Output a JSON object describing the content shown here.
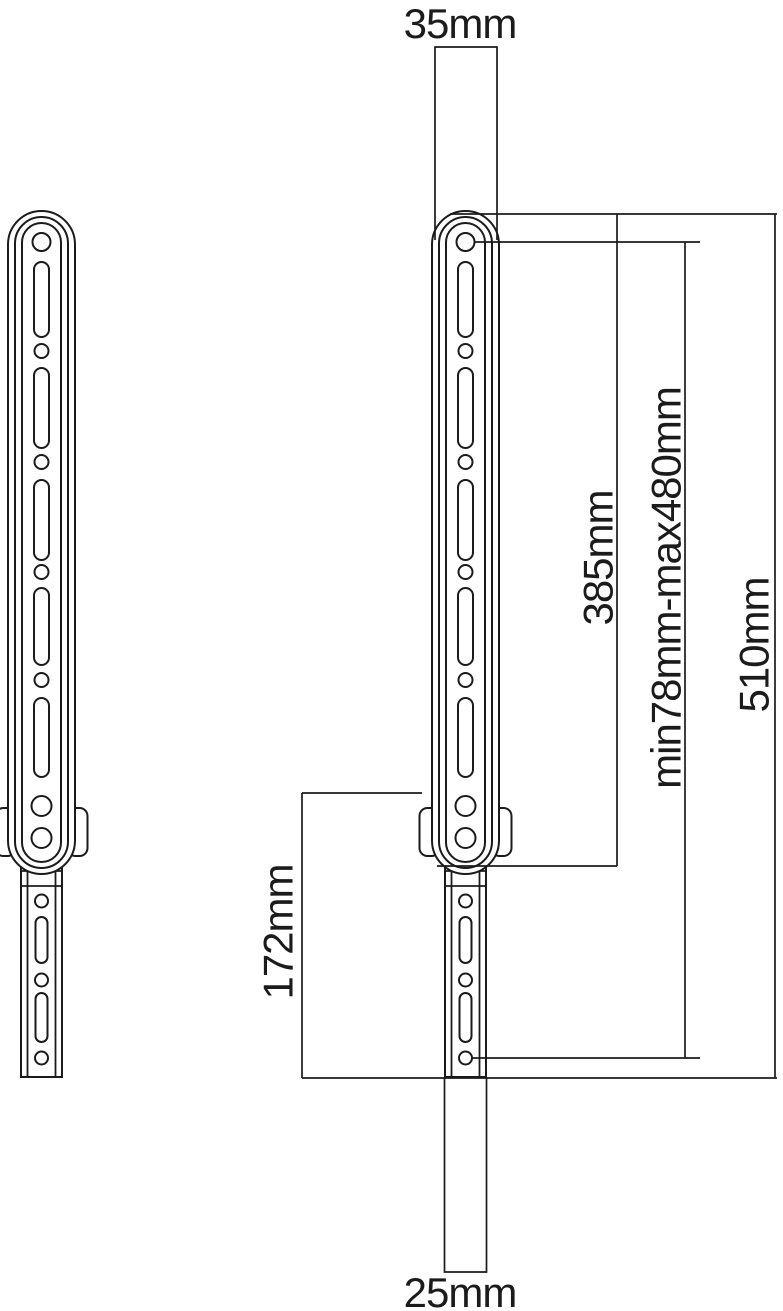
{
  "drawing": {
    "type": "technical-dimension-drawing",
    "dimensions": {
      "top_width": "35mm",
      "bottom_width": "25mm",
      "arm_length": "385mm",
      "adjustment_range": "min78mm-max480mm",
      "overall_length": "510mm",
      "lower_extension_length": "172mm"
    },
    "colors": {
      "line": "#1b1b1b",
      "background": "#ffffff"
    }
  }
}
